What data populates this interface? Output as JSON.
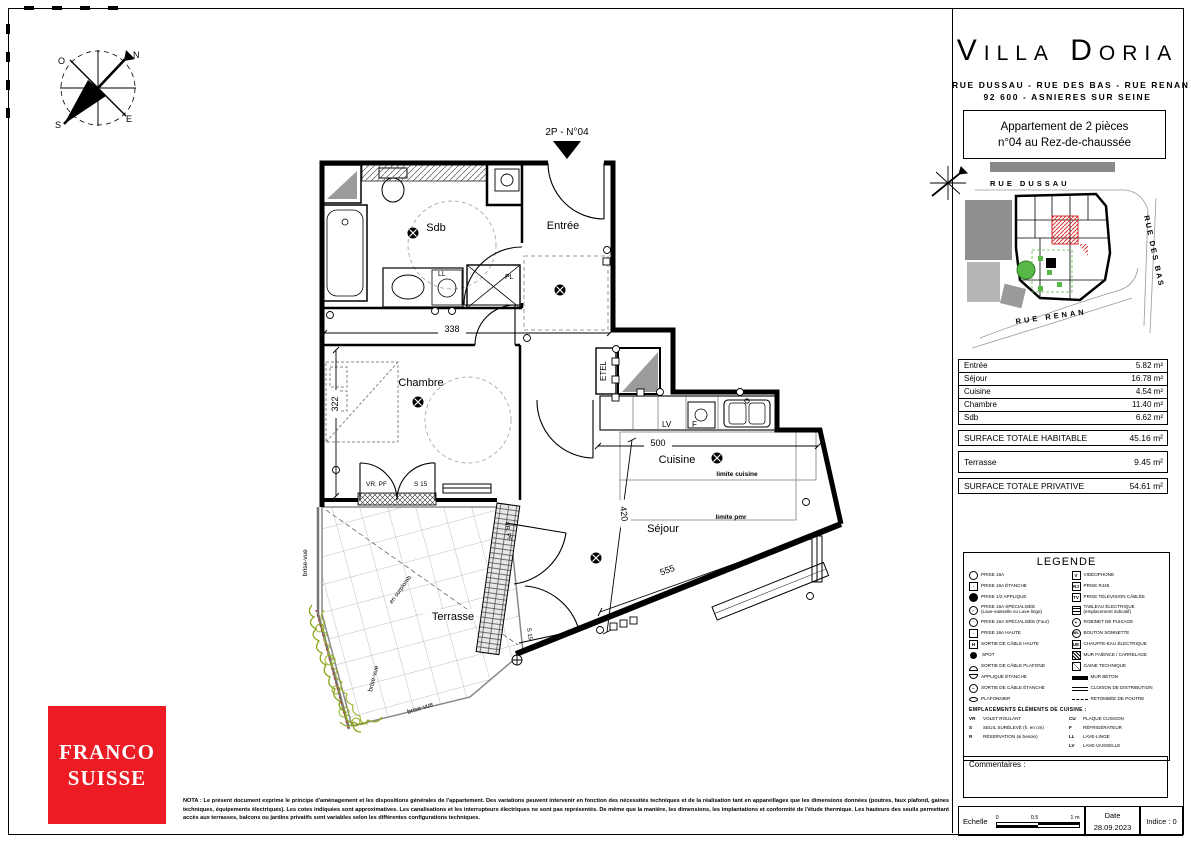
{
  "title_block": {
    "project": "Villa Doria",
    "address_line1": "RUE DUSSAU - RUE DES BAS - RUE RENAN",
    "address_line2": "92 600 -  ASNIERES SUR SEINE",
    "apartment_line1": "Appartement de  2 pièces",
    "apartment_line2": "n°04  au Rez-de-chaussée"
  },
  "site_plan": {
    "street_top": "RUE DUSSAU",
    "street_right": "RUE DES BAS",
    "street_bottom": "RUE RENAN"
  },
  "surface_table": {
    "rows": [
      {
        "label": "Entrée",
        "value": "5.82 m²"
      },
      {
        "label": "Séjour",
        "value": "16.78 m²"
      },
      {
        "label": "Cuisine",
        "value": "4.54 m²"
      },
      {
        "label": "Chambre",
        "value": "11.40 m²"
      },
      {
        "label": "Sdb",
        "value": "6.62 m²"
      }
    ],
    "total_habitable_label": "SURFACE TOTALE HABITABLE",
    "total_habitable_value": "45.16 m²",
    "terrace_label": "Terrasse",
    "terrace_value": "9.45 m²",
    "total_private_label": "SURFACE TOTALE PRIVATIVE",
    "total_private_value": "54.61 m²"
  },
  "legend": {
    "title": "LEGENDE",
    "left": [
      {
        "k": "",
        "t": "PRISE 16A"
      },
      {
        "k": "",
        "t": "PRISE 16A ÉTANCHE"
      },
      {
        "k": "",
        "t": "PRISE 1/2 APPLIQUE"
      },
      {
        "k": "",
        "t": "PRISE 16A SPÉCIALISÉE",
        "t2": "(Lave-vaisselle ou Lave-linge)"
      },
      {
        "k": "",
        "t": "PRISE 16A SPÉCIALISÉE (Four)"
      },
      {
        "k": "",
        "t": "PRISE 16A HAUTE"
      },
      {
        "k": "H",
        "t": "SORTIE DE CÂBLE HAUTE"
      },
      {
        "k": "",
        "t": "SPOT"
      },
      {
        "k": "",
        "t": "SORTIE DE CÂBLE PLAFOND"
      },
      {
        "k": "",
        "t": "APPLIQUE ÉTANCHE"
      },
      {
        "k": "",
        "t": "SORTIE DE CÂBLE ÉTANCHE"
      },
      {
        "k": "",
        "t": "PLAFONNIER"
      }
    ],
    "right": [
      {
        "k": "V",
        "t": "VIDÉOPHONE"
      },
      {
        "k": "RJ",
        "t": "PRISE RJ45"
      },
      {
        "k": "TV",
        "t": "PRISE TÉLÉVISION CÂBLÉE"
      },
      {
        "k": "",
        "t": "TABLEAU ÉLECTRIQUE",
        "t2": "(emplacement indicatif)"
      },
      {
        "k": "",
        "t": "ROBINET DE PUISAGE"
      },
      {
        "k": "BEL",
        "t": "BOUTON SONNETTE"
      },
      {
        "k": "UE",
        "t": "CHAUFFE-EAU ÉLECTRIQUE"
      },
      {
        "k": "",
        "t": "MUR FAÏENCE / CARRELAGE"
      },
      {
        "k": "",
        "t": "GAINE TECHNIQUE"
      },
      {
        "k": "",
        "t": "MUR BÉTON"
      },
      {
        "k": "",
        "t": "CLOISON DE DISTRIBUTION"
      },
      {
        "k": "",
        "t": "RETOMBÉE DE POUTRE"
      }
    ],
    "kitchen_header": "EMPLACEMENTS ÉLÉMENTS DE CUISINE :",
    "kitchen_left": [
      {
        "k": "VR",
        "t": "VOLET ROULANT"
      },
      {
        "k": "S",
        "t": "SEUIL SURÉLEVÉ (h. en cm)"
      },
      {
        "k": "R",
        "t": "RÉSERVATION (si besoin)"
      }
    ],
    "kitchen_right": [
      {
        "k": "CU",
        "t": "PLAQUE CUISSON"
      },
      {
        "k": "F",
        "t": "RÉFRIGÉRATEUR"
      },
      {
        "k": "LL",
        "t": "LAVE-LINGE"
      },
      {
        "k": "LV",
        "t": "LAVE-VAISSELLE"
      }
    ]
  },
  "comments": {
    "label": "Commentaires :"
  },
  "footer": {
    "scale_label": "Echelle",
    "scale_ticks": [
      "0",
      "0.5",
      "1 m"
    ],
    "date_label": "Date",
    "date_value": "28.09.2023",
    "indice": "Indice : 0"
  },
  "plan": {
    "unit_label": "2P - N°04",
    "rooms": {
      "sdb": "Sdb",
      "entree": "Entrée",
      "chambre": "Chambre",
      "cuisine": "Cuisine",
      "sejour": "Séjour",
      "terrasse": "Terrasse",
      "etel": "ETEL"
    },
    "fixtures": {
      "ll": "LL",
      "pl": "PL",
      "lv": "LV",
      "f": "F"
    },
    "limits": {
      "cuisine": "limite cuisine",
      "pmr": "limite pmr"
    },
    "dims": {
      "d338": "338",
      "d322": "322",
      "d500": "500",
      "d555": "555",
      "d420": "420"
    },
    "window_labels": {
      "vrpf": "VR. PF",
      "s15": "S 15"
    },
    "annotations": {
      "brise_vue": "brise-vue",
      "surplomb": "en surplomb"
    }
  },
  "compass": {
    "n": "N",
    "s": "S",
    "e": "E",
    "o": "O"
  },
  "logo": {
    "line1": "FRANCO",
    "line2": "SUISSE",
    "color": "#ED1C24"
  },
  "nota": "NOTA : Le présent document exprime le principe d'aménagement et les dispositions générales de l'appartement. Des variations peuvent intervenir en fonction des nécessités techniques et de la réalisation tant en appareillages que les dimensions données (poutres, faux plafond, gaines techniques, équipements électriques). Les cotes indiquées sont approximatives. Les canalisations et les interrupteurs électriques ne sont pas représentés. De même que la manière, les dimensions, les implantations et conformité de l'étude thermique. Les hauteurs des seuils permettant accès aux terrasses, balcons ou jardins privatifs sont variables selon les différentes configurations techniques."
}
